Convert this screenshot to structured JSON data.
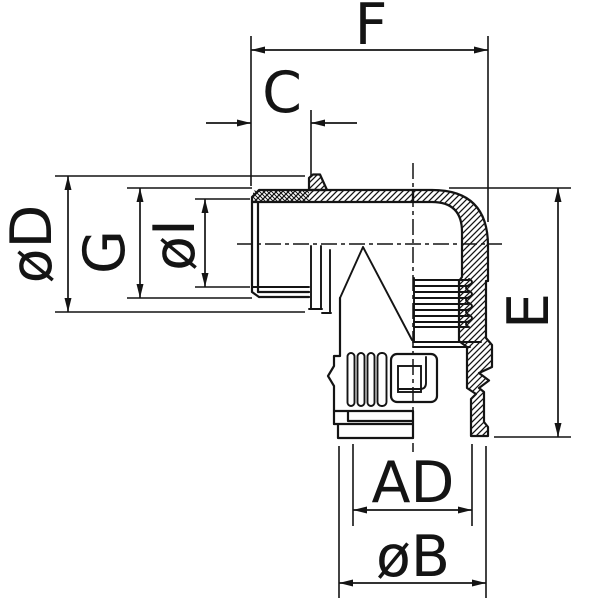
{
  "drawing": {
    "type": "technical-dimension-drawing",
    "subject": "90-degree elbow conduit fitting, half-section view",
    "colors": {
      "line": "#141414",
      "background": "#ffffff"
    },
    "dims": {
      "f": "F",
      "c": "C",
      "d": "øD",
      "g": "G",
      "i": "øI",
      "e": "E",
      "ad": "AD",
      "b": "øB"
    }
  }
}
